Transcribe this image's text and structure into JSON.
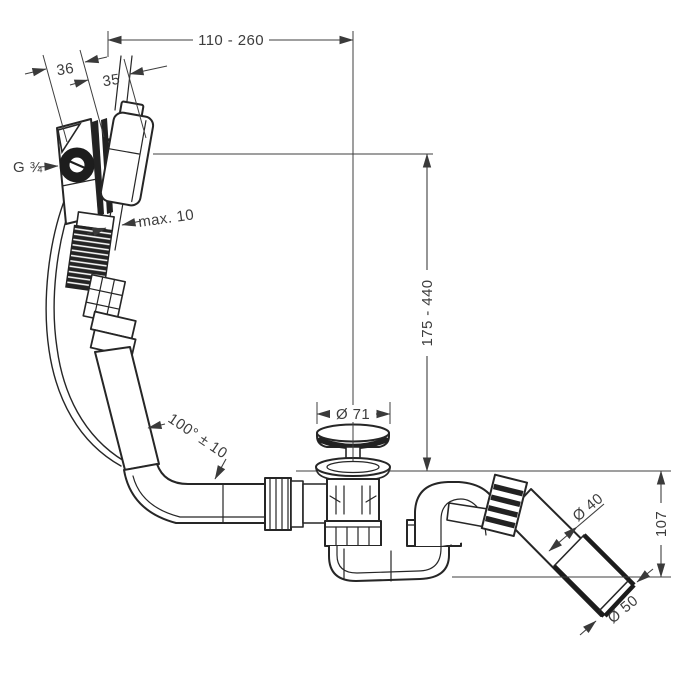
{
  "drawing": {
    "type": "technical-dimension-drawing",
    "subject": "bath-waste-overflow-set-with-rotary-control-and-trap",
    "background_color": "#ffffff",
    "line_color": "#262626",
    "dimension_color": "#3d3d3d",
    "labels": {
      "top_width_range": "110 - 260",
      "body_depth": "36",
      "escutcheon_depth": "35",
      "thread_size": "G ¾",
      "wall_thickness": "max. 10",
      "height_range": "175 - 440",
      "plug_diameter": "Ø 71",
      "hose_angle": "100° ± 10",
      "outlet_pipe_diameter": "Ø 40",
      "trap_outlet_height": "107",
      "outlet_end_diameter": "Ø 50"
    }
  }
}
